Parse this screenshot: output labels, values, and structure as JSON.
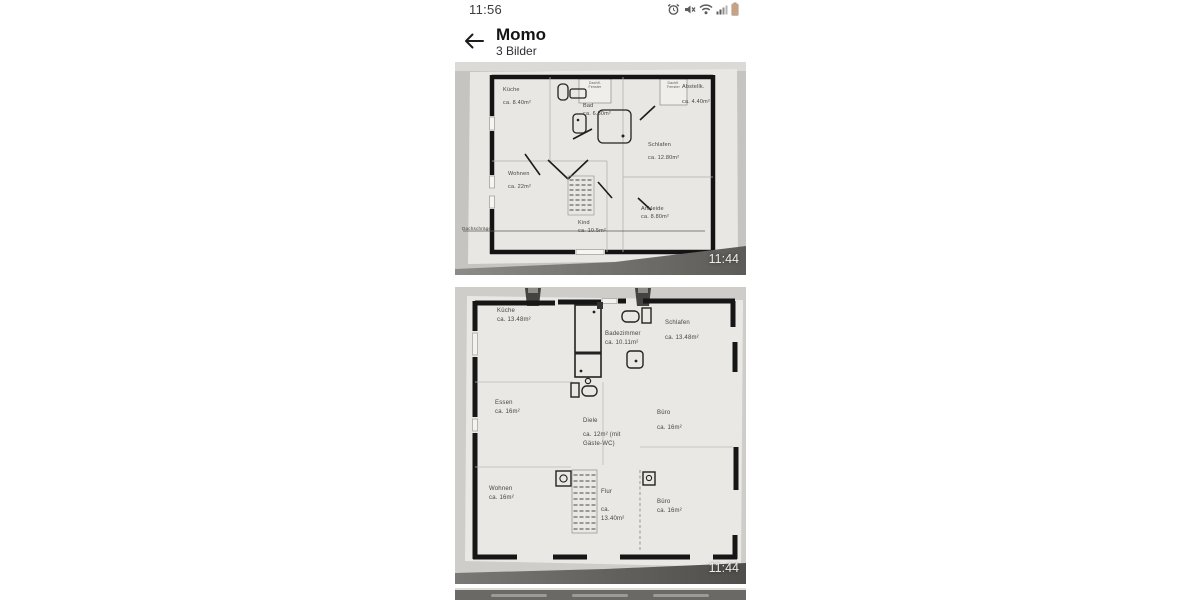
{
  "status_bar": {
    "time": "11:56",
    "icons": [
      "alarm-icon",
      "mute-icon",
      "wifi-icon",
      "signal-icon",
      "battery-icon"
    ],
    "battery_color": "#c9a284"
  },
  "header": {
    "title": "Momo",
    "subtitle": "3 Bilder"
  },
  "plan1": {
    "timestamp": "11:44",
    "kueche_label": "Küche",
    "kueche_area": "ca. 8.40m²",
    "bad_label": "Bad",
    "bad_area": "ca. 6.30m²",
    "roof_window_line1": "Dachfl.",
    "roof_window_line2": "Fenster",
    "abstell_label": "Abstellk.",
    "abstell_area": "ca. 4.40m²",
    "schlafen_label": "Schlafen",
    "schlafen_area": "ca. 12.80m²",
    "wohnen_label": "Wohnen",
    "wohnen_area": "ca. 22m²",
    "kind_label": "Kind",
    "kind_area": "ca. 10.5m²",
    "ankleide_label": "Ankleide",
    "ankleide_area": "ca. 8.80m²",
    "dachschraege_label": "Dachschräge"
  },
  "plan2": {
    "timestamp": "11:44",
    "kueche_label": "Küche",
    "kueche_area": "ca. 13.48m²",
    "bad_label": "Badezimmer",
    "bad_area": "ca. 10.11m²",
    "schlafen_label": "Schlafen",
    "schlafen_area": "ca. 13.48m²",
    "essen_label": "Essen",
    "essen_area": "ca. 16m²",
    "diele_label": "Diele",
    "diele_area_1": "ca. 12m² (mit",
    "diele_area_2": "Gäste-WC)",
    "buero1_label": "Büro",
    "buero1_area": "ca. 16m²",
    "wohnen_label": "Wohnen",
    "wohnen_area": "ca. 16m²",
    "flur_label": "Flur",
    "flur_area_1": "ca.",
    "flur_area_2": "13.40m²",
    "buero2_label": "Büro",
    "buero2_area": "ca. 16m²"
  }
}
